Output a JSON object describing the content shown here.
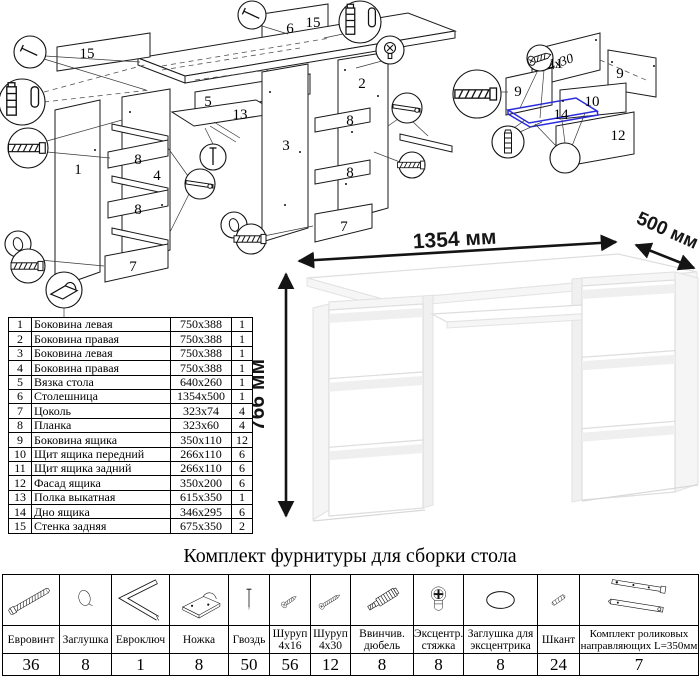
{
  "hardware_section": {
    "title": "Комплект фурнитуры для сборки стола",
    "items": [
      {
        "icon": "euroscrew-icon",
        "name": "Евровинт",
        "qty": "36"
      },
      {
        "icon": "cap-icon",
        "name": "Заглушка",
        "qty": "8"
      },
      {
        "icon": "hexkey-icon",
        "name": "Евроключ",
        "qty": "1"
      },
      {
        "icon": "foot-icon",
        "name": "Ножка",
        "qty": "8"
      },
      {
        "icon": "nail-icon",
        "name": "Гвоздь",
        "qty": "50"
      },
      {
        "icon": "screw-4x16-icon",
        "name": "Шуруп 4x16",
        "qty": "56"
      },
      {
        "icon": "screw-4x30-icon",
        "name": "Шуруп 4x30",
        "qty": "12"
      },
      {
        "icon": "dowel-screw-icon",
        "name": "Ввинчив. дюбель",
        "qty": "8"
      },
      {
        "icon": "cam-lock-icon",
        "name": "Эксцентр. стяжка",
        "qty": "8"
      },
      {
        "icon": "cam-cover-icon",
        "name": "Заглушка для эксцентрика",
        "qty": "8"
      },
      {
        "icon": "wood-dowel-icon",
        "name": "Шкант",
        "qty": "24"
      },
      {
        "icon": "slides-icon",
        "name": "Комплект роликовых направляющих L=350мм",
        "qty": "7"
      }
    ]
  },
  "parts_table": {
    "rows": [
      {
        "num": "1",
        "name": "Боковина левая",
        "size": "750x388",
        "qty": "1"
      },
      {
        "num": "2",
        "name": "Боковина правая",
        "size": "750x388",
        "qty": "1"
      },
      {
        "num": "3",
        "name": "Боковина левая",
        "size": "750x388",
        "qty": "1"
      },
      {
        "num": "4",
        "name": "Боковина правая",
        "size": "750x388",
        "qty": "1"
      },
      {
        "num": "5",
        "name": "Вязка стола",
        "size": "640x260",
        "qty": "1"
      },
      {
        "num": "6",
        "name": "Столешница",
        "size": "1354x500",
        "qty": "1"
      },
      {
        "num": "7",
        "name": "Цоколь",
        "size": "323x74",
        "qty": "4"
      },
      {
        "num": "8",
        "name": "Планка",
        "size": "323x60",
        "qty": "4"
      },
      {
        "num": "9",
        "name": "Боковина ящика",
        "size": "350x110",
        "qty": "12"
      },
      {
        "num": "10",
        "name": "Щит ящика передний",
        "size": "266x110",
        "qty": "6"
      },
      {
        "num": "11",
        "name": "Щит ящика задний",
        "size": "266x110",
        "qty": "6"
      },
      {
        "num": "12",
        "name": "Фасад ящика",
        "size": "350x200",
        "qty": "6"
      },
      {
        "num": "13",
        "name": "Полка выкатная",
        "size": "615x350",
        "qty": "1"
      },
      {
        "num": "14",
        "name": "Дно ящика",
        "size": "346x295",
        "qty": "6"
      },
      {
        "num": "15",
        "name": "Стенка задняя",
        "size": "675x350",
        "qty": "2"
      }
    ]
  },
  "desk_figure": {
    "width_label": "1354 мм",
    "depth_label": "500 мм",
    "height_label": "766 мм"
  },
  "diagram_main": {
    "labels": {
      "strip_left": "15",
      "top": "6",
      "strip_right": "15",
      "side_outer_left": "1",
      "side_inner_left": "4",
      "plank_left_1": "8",
      "plank_left_2": "8",
      "plinth_left": "7",
      "tie": "5",
      "shelf": "13",
      "side_inner_right": "3",
      "side_outer_right": "2",
      "plank_right_1": "8",
      "plank_right_2": "8",
      "plinth_right": "7"
    }
  },
  "diagram_drawer": {
    "labels": {
      "back": "11",
      "side_left": "9",
      "side_right": "9",
      "front_inner": "10",
      "bottom": "14",
      "facade": "12"
    },
    "screw_note": "4x30"
  }
}
